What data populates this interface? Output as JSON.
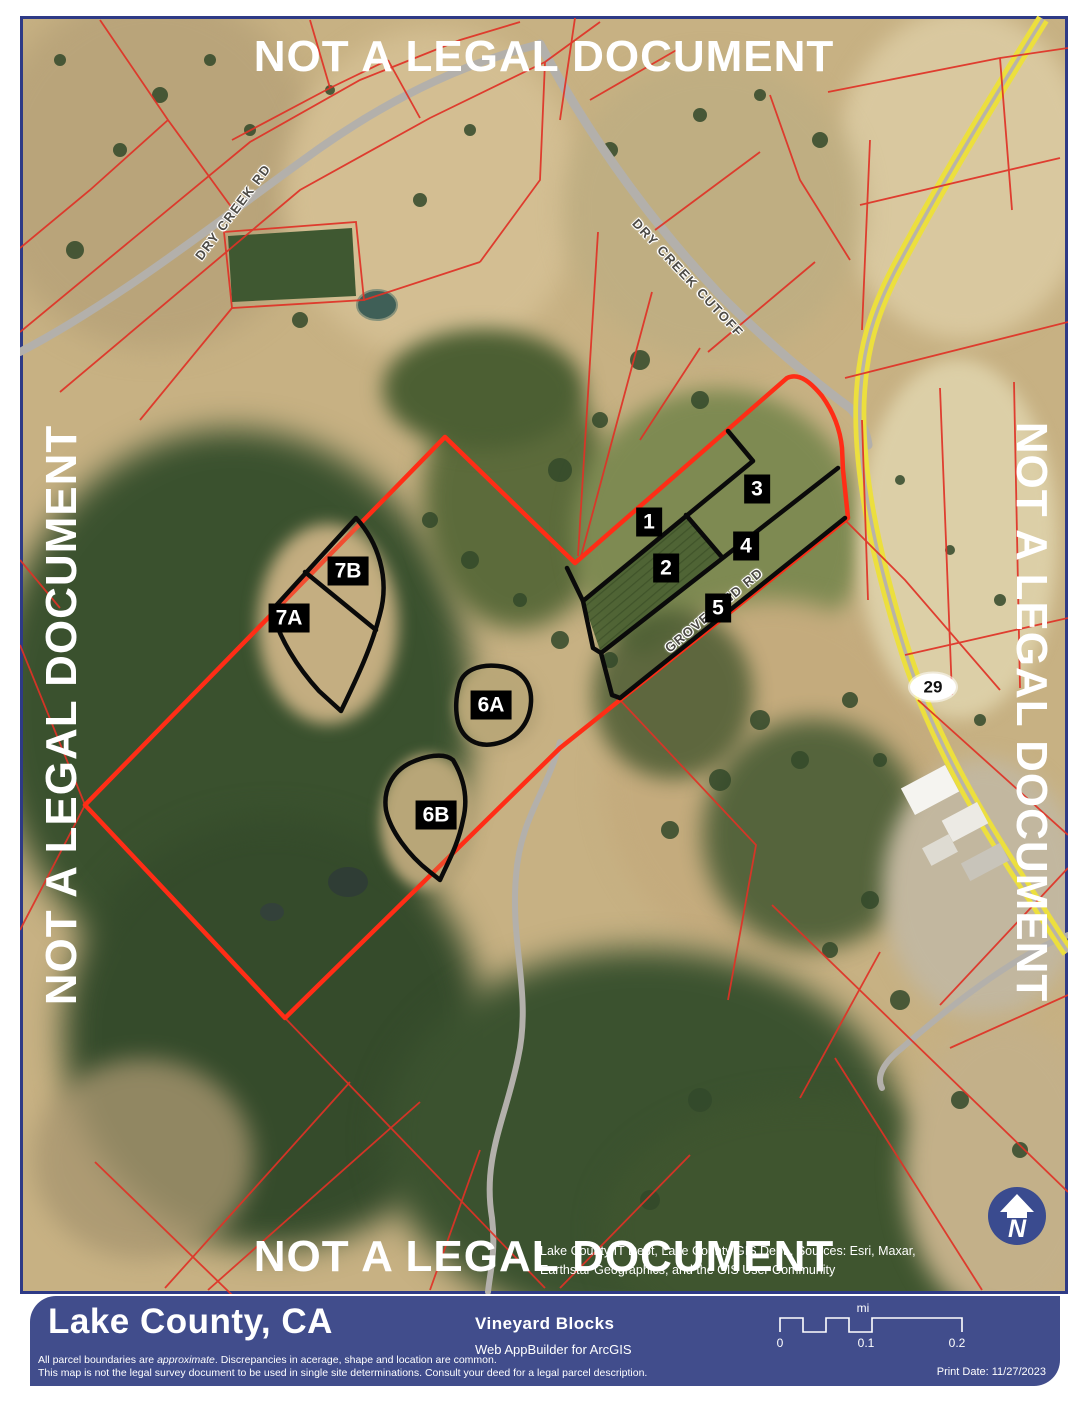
{
  "watermark": "NOT A LEGAL DOCUMENT",
  "map": {
    "road_labels": {
      "dry_creek_rd": "DRY CREEK RD",
      "dry_creek_cutoff": "DRY CREEK CUTOFF",
      "groveland_rd": "GROVELAND RD"
    },
    "highway_shield": "29",
    "blocks": {
      "b1": "1",
      "b2": "2",
      "b3": "3",
      "b4": "4",
      "b5": "5",
      "b6a": "6A",
      "b6b": "6B",
      "b7a": "7A",
      "b7b": "7B"
    },
    "north_letter": "N",
    "attribution_line1": "Lake County IT Dept, Lake County GIS Dept., Sources: Esri, Maxar,",
    "attribution_line2": "Earthstar Geographics, and the GIS User Community"
  },
  "footer": {
    "county": "Lake County, CA",
    "title": "Vineyard Blocks",
    "subtitle": "Web AppBuilder for ArcGIS",
    "disclaimer_l1a": "All parcel boundaries are ",
    "disclaimer_l1b": "approximate",
    "disclaimer_l1c": ".  Discrepancies in acerage, shape and location are common.",
    "disclaimer_l2": "This map is not the legal survey document to be used in single site determinations.  Consult your deed for a legal parcel description.",
    "print_date": "Print Date: 11/27/2023",
    "scale": {
      "unit": "mi",
      "t0": "0",
      "t1": "0.1",
      "t2": "0.2"
    }
  },
  "colors": {
    "footer_blue": "#414d8c",
    "parcel_red": "#e03226",
    "boundary_red": "#ff2d16",
    "block_outline": "#000000",
    "highway_yellow": "#ecdf3e",
    "frame_navy": "#2e3a86"
  }
}
